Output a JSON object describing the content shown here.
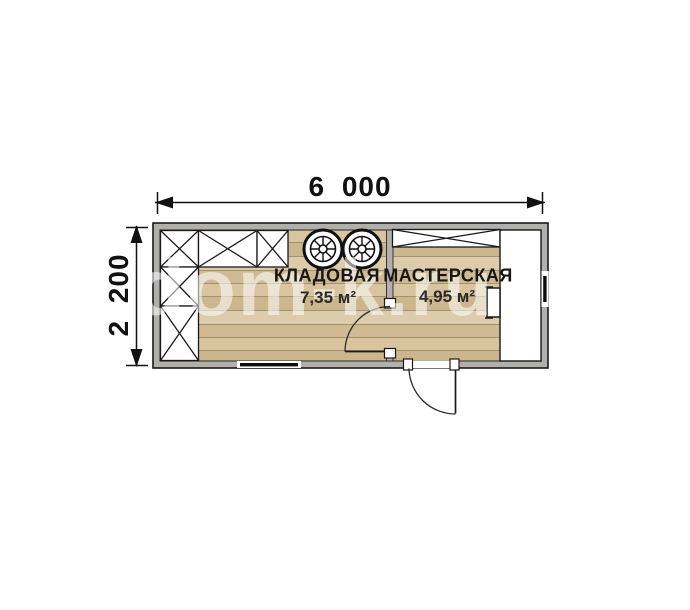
{
  "floorplan": {
    "dimensions": {
      "width_label": "6 000",
      "height_label": "2 200"
    },
    "rooms": [
      {
        "name": "КЛАДОВАЯ",
        "area": "7,35 м²"
      },
      {
        "name": "МАСТЕРСКАЯ",
        "area": "4,95 м²"
      }
    ],
    "watermark": "dom-k.ru",
    "colors": {
      "wall_gray": "#b2b0ad",
      "floor_plank_light": "#dcccab",
      "floor_plank_mid": "#d8c5a0",
      "floor_plank_dark": "#cbb68d",
      "plank_seam": "#a3916e",
      "line_black": "#1a1a1a",
      "furniture_white": "#ffffff",
      "watermark_white": "#ffffff"
    },
    "icons": {
      "shelving": "x-crossed-rectangle",
      "barrels": "spoked-circle",
      "doors": "quarter-arc-swing",
      "windows": "black-bar-in-wall"
    }
  }
}
